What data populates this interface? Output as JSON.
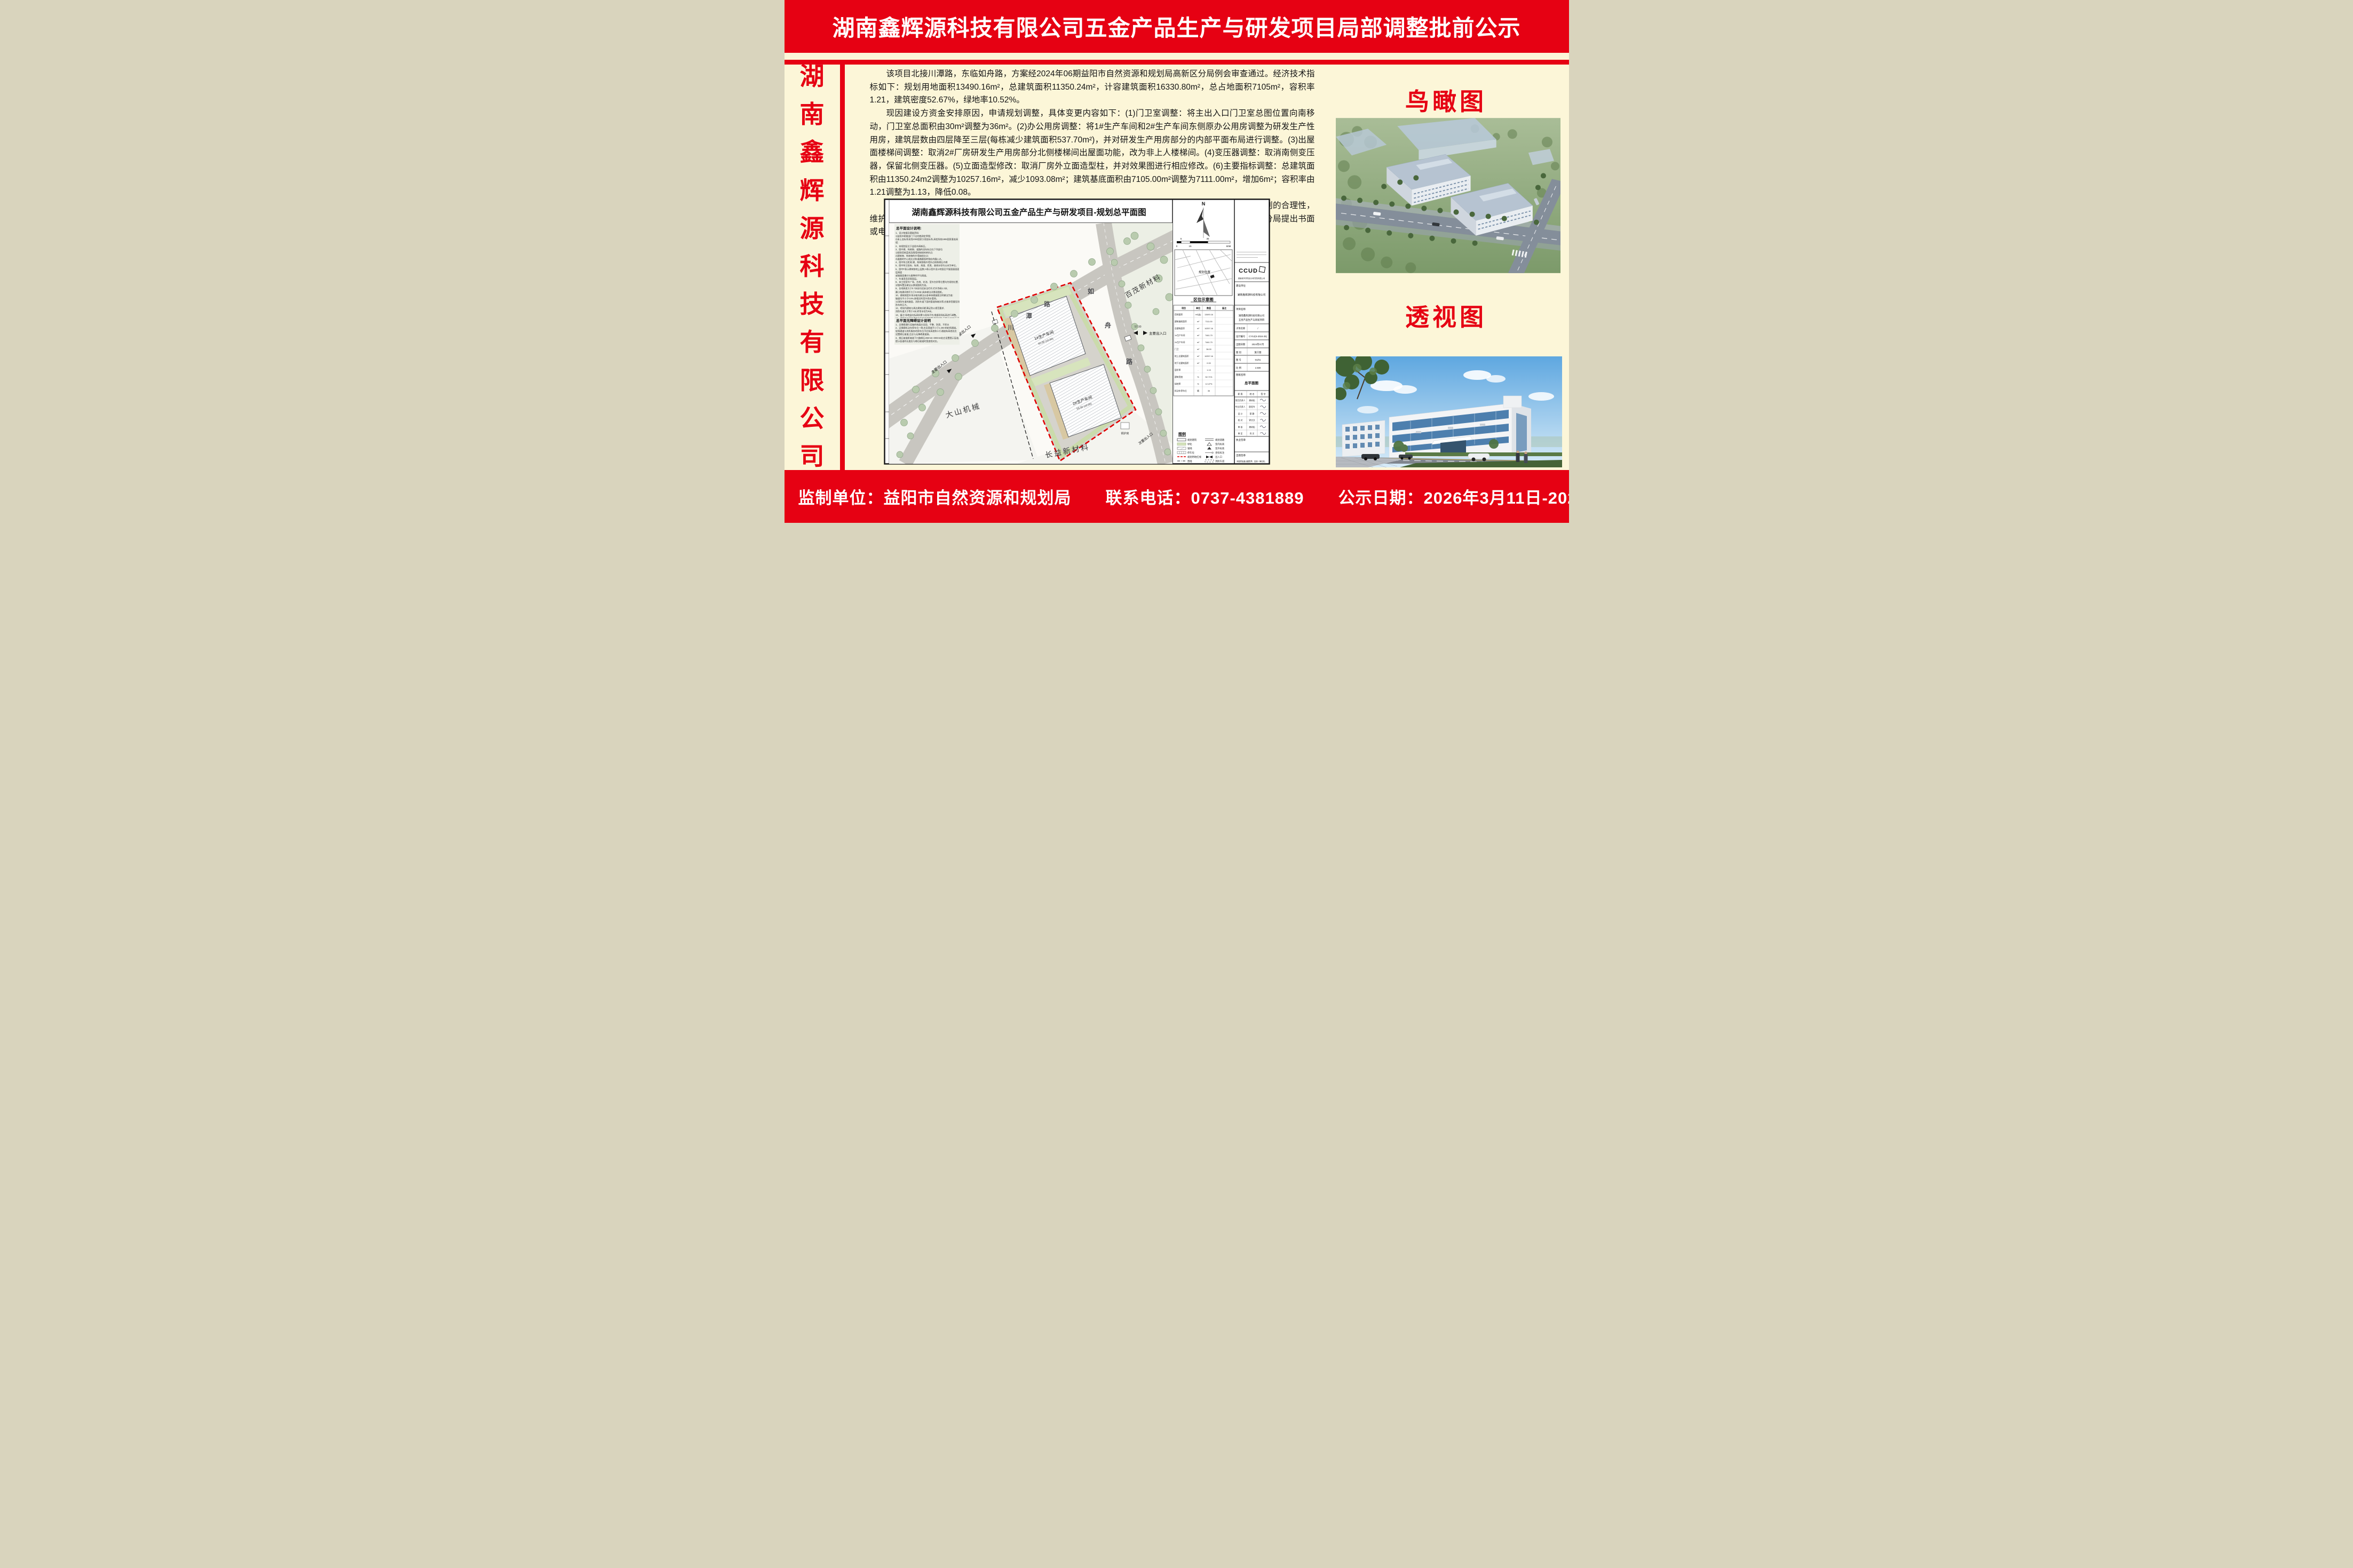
{
  "colors": {
    "banner_red": "#e60113",
    "cream": "#fcf6d8",
    "boundary_red": "#e00000"
  },
  "header": {
    "title": "湖南鑫辉源科技有限公司五金产品生产与研发项目局部调整批前公示"
  },
  "sidebar": {
    "company": "湖南鑫辉源科技有限公司",
    "chars": [
      "湖",
      "南",
      "鑫",
      "辉",
      "源",
      "科",
      "技",
      "有",
      "限",
      "公",
      "司"
    ]
  },
  "body": {
    "p1": "该项目北接川潭路，东临如舟路，方案经2024年06期益阳市自然资源和规划局高新区分局例会审查通过。经济技术指标如下：规划用地面积13490.16m²，总建筑面积11350.24m²，计容建筑面积16330.80m²，总占地面积7105m²，容积率1.21，建筑密度52.67%，绿地率10.52%。",
    "p2": "现因建设方资金安排原因，申请规划调整，具体变更内容如下：(1)门卫室调整：将主出入口门卫室总图位置向南移动，门卫室总面积由30m²调整为36m²。(2)办公用房调整：将1#生产车间和2#生产车间东侧原办公用房调整为研发生产性用房，建筑层数由四层降至三层(每栋减少建筑面积537.70m²)，并对研发生产用房部分的内部平面布局进行调整。(3)出屋面楼梯间调整：取消2#厂房研发生产用房部分北侧楼梯间出屋面功能，改为非上人楼梯间。(4)变压器调整：取消南侧变压器，保留北侧变压器。(5)立面造型修改：取消厂房外立面造型柱，并对效果图进行相应修改。(6)主要指标调整：总建筑面积由11350.24m2调整为10257.16m²，减少1093.08m²；建筑基底面积由7105.00m²调整为7111.00m²，增加6m²；容积率由1.21调整为1.13，降低0.08。",
    "p3": "根据《中华人民共和国城乡规划法》、《中华人民共和国行政许可法》等法律法规的规定，为保障城乡规划的合理性，维护相关利益人的合法权益，相关利益人可在本公示之日起七个工作日内向益阳市自然资源和规划局高新区分局提出书面或电话意见，逾期视为无异议。"
  },
  "plan": {
    "title": "湖南鑫辉源科技有限公司五金产品生产与研发项目-规划总平面图",
    "notes_title": "总平面设计说明:",
    "notes_text": "1、设计依据及基础资料:\n1)益阳市职能部门下达的勘测定界图;\n2)本土坐标系采用2000国家大地坐标系,高程系统1985国家基准高程;\n2、本规划区位于益阳市高新区。\n3、图中建、构筑物、道路的坐标标注在下列部位\n1)规划用地蓝线及围墙控制线的转折点;\n2)建筑物、构筑物的外墙轴线交点;\n3)道路的中心线交点和道路圆弧转角处的圆心点。\n4、图中所注距离:建、构筑物指外墙外边线和缘石内缘\n5、图中所注坐标、标高、高度、距离、曲线半径均以米为单位。\n6、图中F表示建筑物地上层数,H表示室外设计地面至平屋面屋面面层高度\n或坡屋面檐口与屋脊的平均高度。\n7、车道采用沥青面层。\n8、本工程室外广场、台地、花池、室外台阶等位置均为规划位置,\n详细布置及做法以景观图纸为准。\n9、台地高差大于0.7米处均设安全栏杆,栏杆净高1.3米,\n最小构建间隙不大于0.90米:具体做法详景观图纸。\n10、建筑物室外排水暗沟做法以各单体建施图注明做法为准:\n坡度均不小于0.5%,接相近的室外雨水管网。\n11消防车道的路面、消防车道下面的管道和暗沟等,应能承受重型消防车的压力。\n12、地块内建筑与周边建筑间距满足防火规范要求,\n消防车道大于等于4米,转弯半径为9米。\n13、备注:场地竖向标高如果与现场不符,根据现场标高进行调整。\n14、建筑施工现场建筑垃圾的总控制量:砖混结构 不超过400T/万平方米;\n现浇混凝土结构不超过300T/万平方米;装配式建筑不超过200T/万平方米。\n15、场地已平整,无土石方转运。",
    "notes2_title": "总平面无障碍设计说明",
    "notes2_text": "1、无障碍通行设施的地面应坚固、平整、防滑、不积水\n2、无障碍机动车停车位一侧,应设宽度不小于1.20m的轮椅通道。\n轮椅通道与其所服务的停车位不应有高差和人行通道有高差处应\n设置缘石坡道,且应与无障碍通道接。\n3、缘石坡道距坡道下口路缘石250mm~300mm处应设置提示盲道,\n提示盲道的长度应与缘石坡道的宽度相对应。",
    "roads": {
      "chuantan": [
        "川",
        "潭",
        "路"
      ],
      "ruzhou": [
        "如",
        "舟",
        "路"
      ]
    },
    "labels": {
      "parcel_top_right": "百茂新材料",
      "parcel_left": "大山机械",
      "parcel_bottom": "长益新材料",
      "boiler": "锅炉房",
      "main_entrance": "主要出入口",
      "secondary_entrance": "次要出入口",
      "building1": "1#生产车间",
      "building1_sub": "60.00 (±0.00)",
      "building2": "2#生产车间",
      "building2_sub": "59.50 (±0.00)",
      "elev": "57.90"
    },
    "north": "N",
    "scale": {
      "s0": "0",
      "s5": "5",
      "s15": "15",
      "s35": "35",
      "s60": "60M"
    },
    "location": {
      "title": "区位示意图",
      "marker": "规划位置"
    },
    "table": {
      "headers": [
        "项目",
        "单位",
        "数值",
        "备注"
      ],
      "rows": [
        [
          "用地面积",
          "m²(亩)",
          "13490.16"
        ],
        [
          "建筑基底面积",
          "m²",
          "7111.00"
        ],
        [
          "总建筑面积",
          "m²",
          "10257.16"
        ],
        [
          "1#生产车间",
          "m²",
          "7461.70"
        ],
        [
          "2#生产车间",
          "m²",
          "7461.70"
        ],
        [
          "门卫",
          "m²",
          "36.00"
        ],
        [
          "地上总建筑面积",
          "m²",
          "10257.16"
        ],
        [
          "地下总建筑面积",
          "m²",
          "0.00"
        ],
        [
          "容积率",
          "-",
          "1.13"
        ],
        [
          "建筑密度",
          "%",
          "52.71%"
        ],
        [
          "绿地率",
          "%",
          "12.47%"
        ],
        [
          "机动车停车位",
          "辆",
          "35"
        ]
      ]
    },
    "legend": {
      "title": "图例",
      "left": [
        "规划建筑",
        "绿化",
        "铺地",
        "停车位",
        "规划用地红线",
        "围墙"
      ],
      "right": [
        "规划道路",
        "室内标高",
        "室外标高",
        "坐标标注",
        "出入口",
        "消防车道"
      ]
    },
    "tb": {
      "logo": "CCUD",
      "sub": "湖南城市学院设计研究院有限公司",
      "owner_label": "建设单位",
      "owner": "湖南鑫辉源科技有限公司",
      "project_label": "项目名称",
      "project_l1": "湖南鑫辉源科技有限公司",
      "project_l2": "五金产品生产与研发项目",
      "rows": [
        [
          "子项名称",
          "/"
        ],
        [
          "设计编号",
          "CYSJ(S-2024-25)"
        ],
        [
          "出图日期",
          "2024年07月"
        ],
        [
          "图  别",
          "施工图"
        ],
        [
          "图  号",
          "01/01"
        ],
        [
          "比  例",
          "1:500"
        ]
      ],
      "sheet_label": "图纸名称",
      "sheet": "总平面图",
      "sign_headers": [
        "职 责",
        "姓 名",
        "签 字"
      ],
      "signs": [
        [
          "项目负责人",
          "龚树松"
        ],
        [
          "专业负责人",
          "欧阳令"
        ],
        [
          "设  计",
          "蔡  静"
        ],
        [
          "校  对",
          "钟文文"
        ],
        [
          "审  核",
          "龚树松"
        ],
        [
          "审  定",
          "肖  文"
        ]
      ],
      "stamp1": "执业签章",
      "stamp2": "出图签章",
      "note": "本图须加盖出图签章，否则一律无效。"
    }
  },
  "right": {
    "birdseye": "鸟瞰图",
    "perspective": "透视图"
  },
  "footer": {
    "text": "监制单位：益阳市自然资源和规划局　　联系电话：0737-4381889　　公示日期：2026年3月11日-2026年3月19日"
  }
}
